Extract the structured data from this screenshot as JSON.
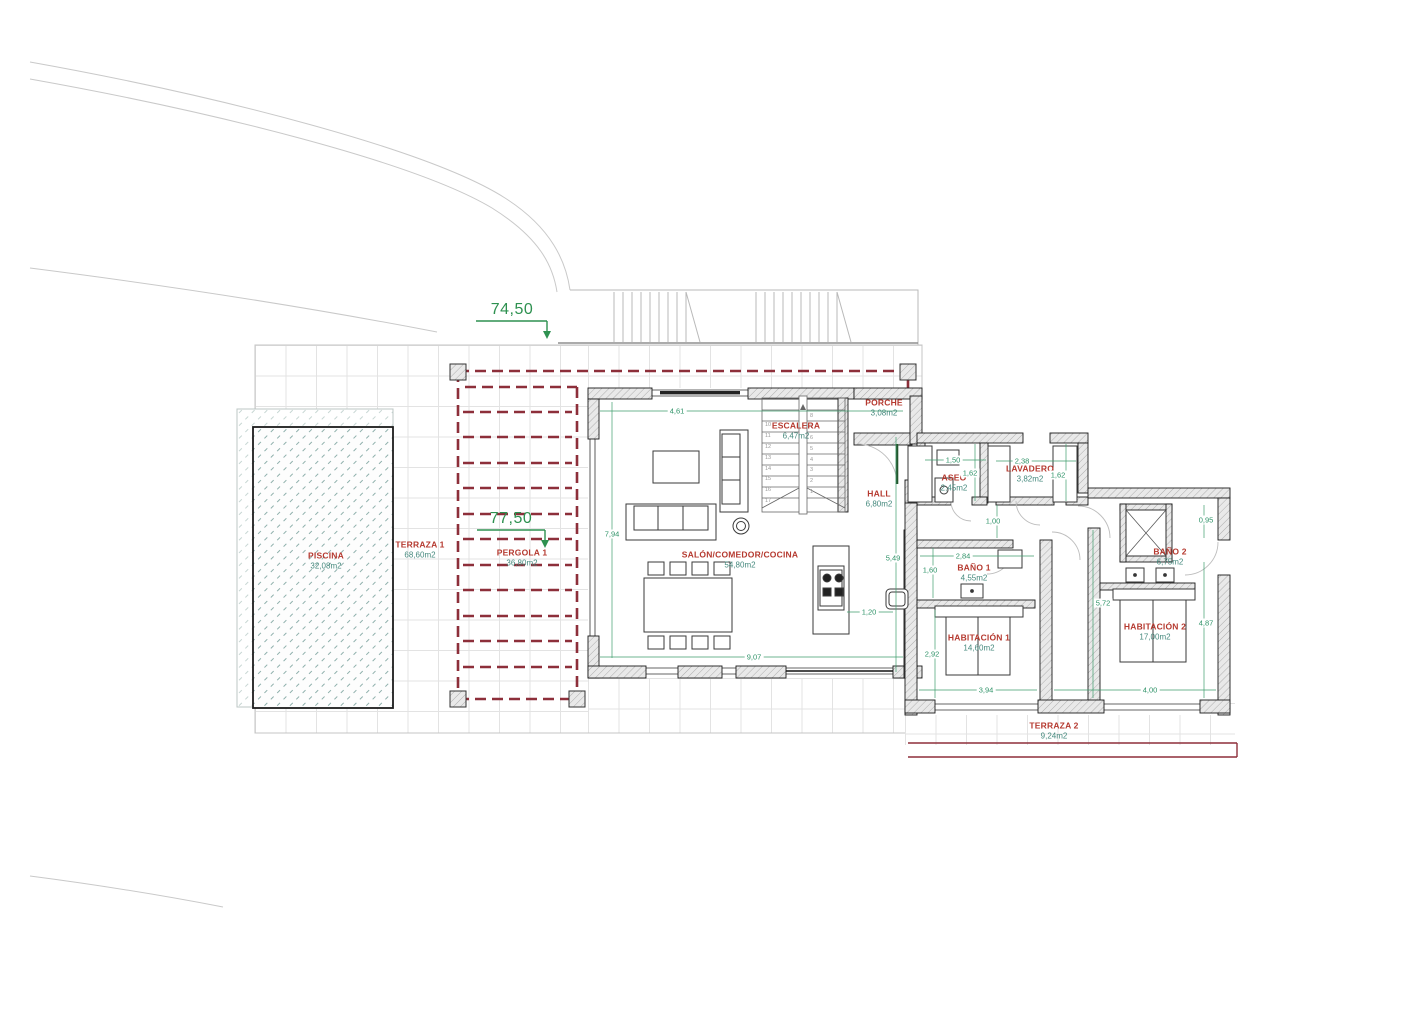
{
  "drawing_title": "Planta vivienda - floor plan",
  "levels": {
    "upper": "74,50",
    "lower": "77,50"
  },
  "rooms": {
    "piscina": {
      "name": "PISCINA",
      "area": "32,08m2"
    },
    "terraza1": {
      "name": "TERRAZA 1",
      "area": "68,60m2"
    },
    "pergola1": {
      "name": "PERGOLA 1",
      "area": "36,80m2"
    },
    "salon": {
      "name": "SALÓN/COMEDOR/COCINA",
      "area": "54,80m2"
    },
    "escalera": {
      "name": "ESCALERA",
      "area": "6,47m2"
    },
    "porche": {
      "name": "PORCHE",
      "area": "3,08m2"
    },
    "hall": {
      "name": "HALL",
      "area": "6,80m2"
    },
    "aseo": {
      "name": "ASEO",
      "area": "2,45m2"
    },
    "lavadero": {
      "name": "LAVADERO",
      "area": "3,82m2"
    },
    "bano1": {
      "name": "BAÑO 1",
      "area": "4,55m2"
    },
    "habitacion1": {
      "name": "HABITACIÓN 1",
      "area": "14,60m2"
    },
    "bano2": {
      "name": "BAÑO 2",
      "area": "6,75m2"
    },
    "habitacion2": {
      "name": "HABITACIÓN 2",
      "area": "17,00m2"
    },
    "terraza2": {
      "name": "TERRAZA 2",
      "area": "9,24m2"
    }
  },
  "dimensions": {
    "salon_top": "4,61",
    "salon_left": "7,94",
    "salon_bottom": "9,07",
    "kitchen_island": "1,20",
    "salon_right": "5,49",
    "aseo_w": "1,50",
    "aseo_h": "1,62",
    "lavadero_w": "2,38",
    "lavadero_h": "1,62",
    "hall_corridor": "1,00",
    "bano1_w": "2,84",
    "bano1_h": "1,60",
    "hab1_h": "2,92",
    "hab1_w": "3,94",
    "hab2_w": "4,00",
    "corridor_v": "5,72",
    "bano2_top": "0,95",
    "hab2_right": "4,87"
  },
  "stairs": {
    "left": [
      "10",
      "11",
      "12",
      "13",
      "14",
      "15",
      "16",
      "17"
    ],
    "right": [
      "8",
      "7",
      "6",
      "5",
      "4",
      "3",
      "2",
      "1"
    ]
  },
  "colors": {
    "room_label": "#b5392f",
    "room_area": "#45897d",
    "dimension": "#2f9368",
    "level_marker": "#2e9150",
    "pergola_dashed": "#8d2f3a",
    "terraza2_line": "#8d2f3a",
    "wall_hatch": "#adadad",
    "pool_hatch": "#8fb0ac"
  }
}
